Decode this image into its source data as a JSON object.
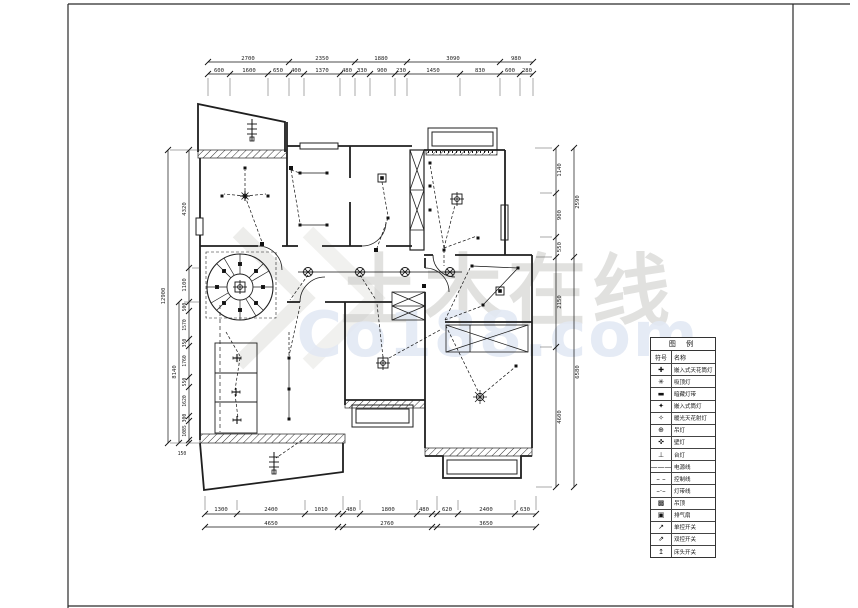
{
  "watermark": {
    "brand": "土木在线",
    "domain": "Co188.com"
  },
  "dims": {
    "top_outer": [
      "2700",
      "2350",
      "1880",
      "3090",
      "980"
    ],
    "top_inner": [
      "600",
      "1600",
      "650",
      "400",
      "1370",
      "480",
      "330",
      "900",
      "230",
      "1450",
      "830",
      "600",
      "280"
    ],
    "bottom_inner": [
      "1300",
      "2400",
      "1010",
      "480",
      "1800",
      "480",
      "620",
      "2400",
      "630"
    ],
    "bottom_outer": [
      "4650",
      "2760",
      "3650"
    ],
    "left_outer": "12900",
    "left_mid": "8140",
    "left_upper": [
      "4320",
      "1100"
    ],
    "left_lower": [
      "500",
      "1570",
      "350",
      "1760",
      "550",
      "1620",
      "300",
      "1085"
    ],
    "left_corner": "150",
    "right_inner": [
      "1140",
      "900",
      "550",
      "2150",
      "4600"
    ],
    "right_outer": [
      "2590",
      "6580"
    ]
  },
  "legend": {
    "title": "图 例",
    "col_symbol": "符号",
    "col_name": "名称",
    "rows": [
      {
        "symbol": "✚",
        "name": "嵌入式天花筒灯"
      },
      {
        "symbol": "✳",
        "name": "吸顶灯"
      },
      {
        "symbol": "▬",
        "name": "暗藏灯带"
      },
      {
        "symbol": "✦",
        "name": "嵌入式筒灯"
      },
      {
        "symbol": "✧",
        "name": "暖光天花射灯"
      },
      {
        "symbol": "⊕",
        "name": "吊灯"
      },
      {
        "symbol": "✜",
        "name": "壁灯"
      },
      {
        "symbol": "⊥",
        "name": "台灯"
      },
      {
        "symbol": "———",
        "name": "电源线"
      },
      {
        "symbol": "– –",
        "name": "控制线"
      },
      {
        "symbol": "–·–",
        "name": "灯带线"
      },
      {
        "symbol": "▩",
        "name": "吊顶"
      },
      {
        "symbol": "▣",
        "name": "排气扇"
      },
      {
        "symbol": "↗",
        "name": "单控开关"
      },
      {
        "symbol": "⇗",
        "name": "双控开关"
      },
      {
        "symbol": "↥",
        "name": "床头开关"
      }
    ]
  },
  "colors": {
    "line": "#1f1f1f",
    "watermark_gray": "#c9c9c6",
    "watermark_blue": "#e3e9f4",
    "background": "#ffffff"
  }
}
